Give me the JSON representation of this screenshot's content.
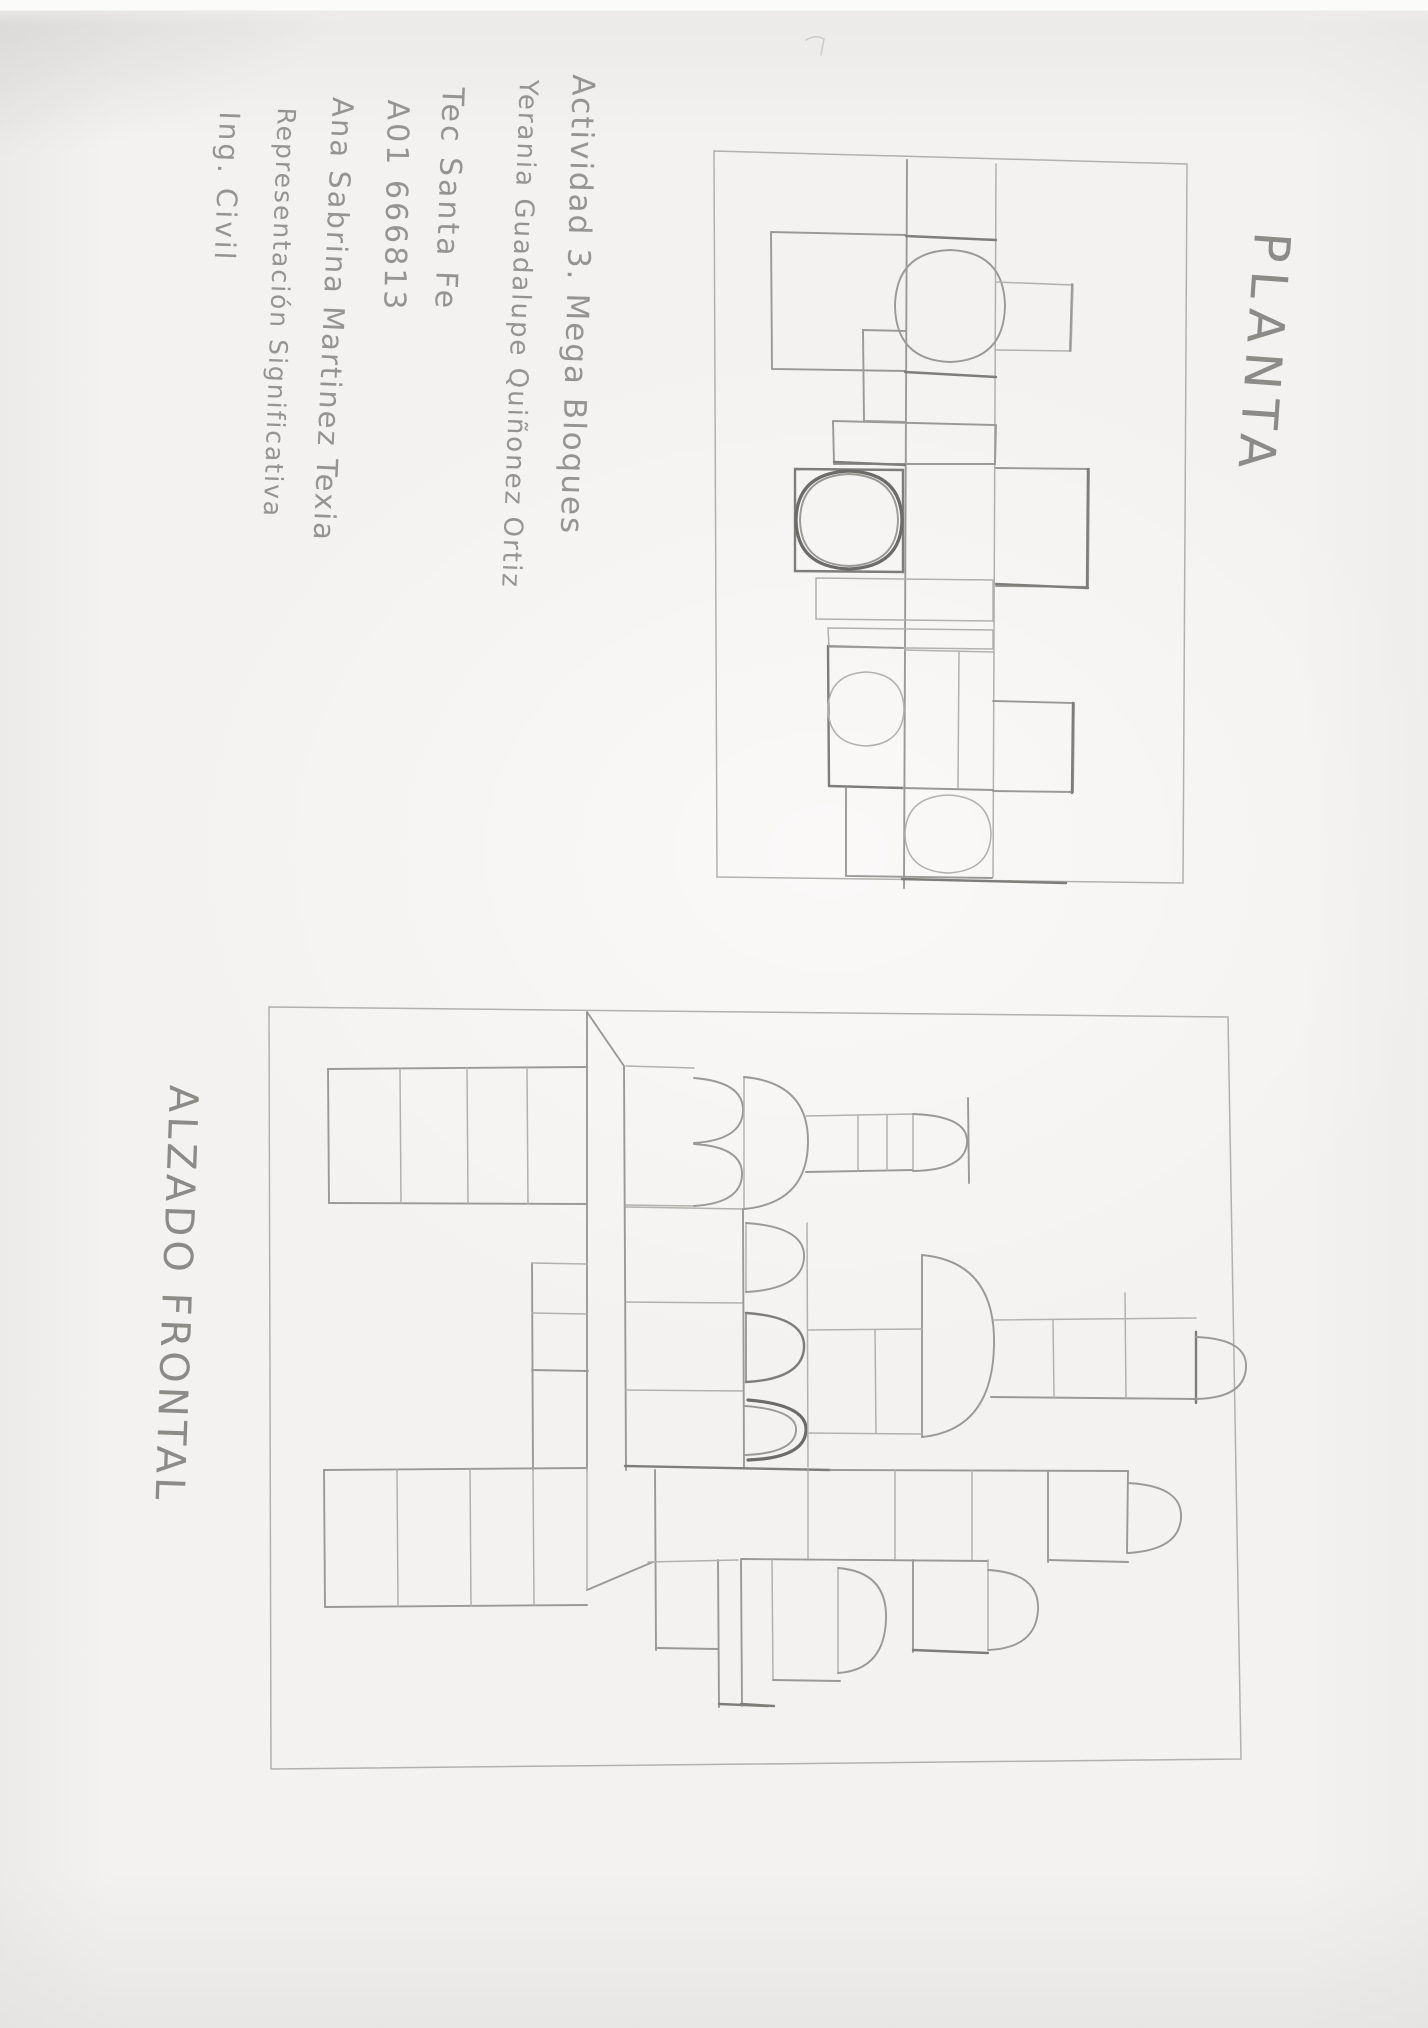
{
  "colors": {
    "paper": "#f4f2f0",
    "pencil": "#8f8d8a",
    "pencil_dark": "#6d6b68"
  },
  "title_block": {
    "lines": [
      {
        "text": "Actividad 3. Mega Bloques"
      },
      {
        "text": "Yerania Guadalupe Quiñonez Ortiz"
      },
      {
        "text": "Tec Santa Fe"
      },
      {
        "text": "A01 666813"
      },
      {
        "text": "Ana Sabrina Martinez Texia"
      },
      {
        "text": "Representación Significativa"
      },
      {
        "text": "Ing. Civil"
      }
    ]
  },
  "plan": {
    "title": "PLANTA"
  },
  "elevation": {
    "title": "ALZADO FRONTAL"
  }
}
